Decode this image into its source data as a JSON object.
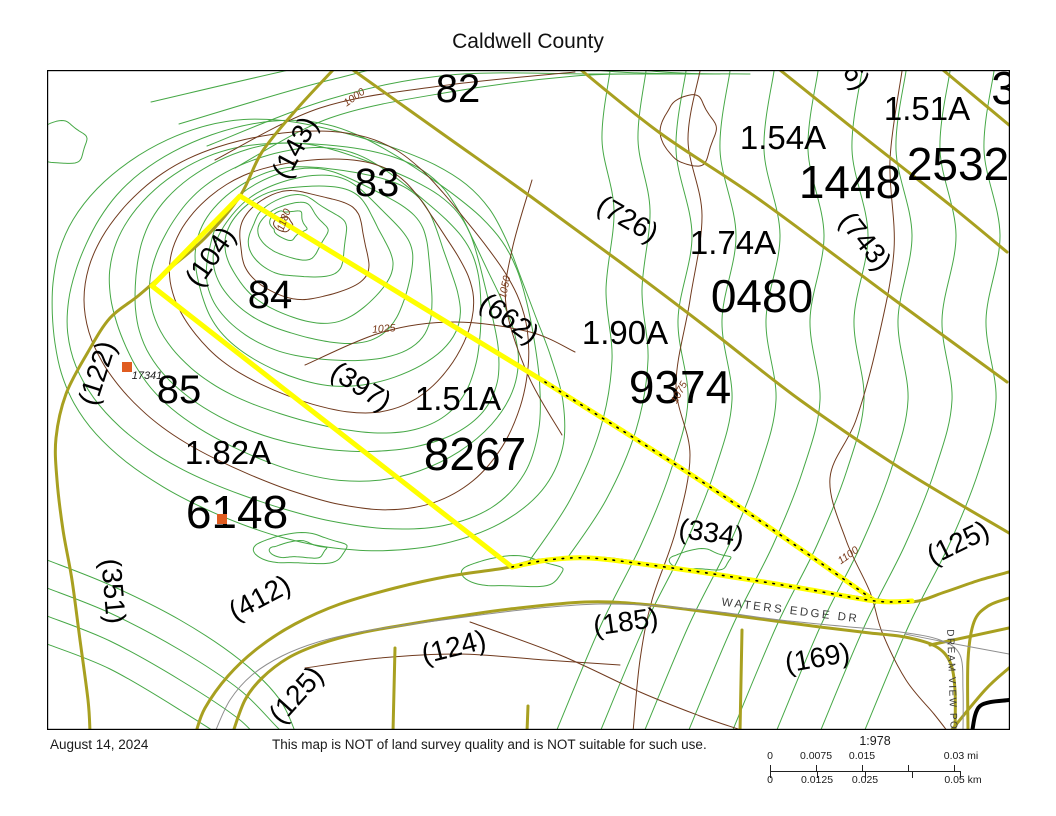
{
  "title": "Caldwell County",
  "footer": {
    "date": "August 14, 2024",
    "disclaimer": "This map is NOT of land survey quality and is NOT suitable for such use.",
    "scale": {
      "ratio": "1:978",
      "mi_ticks": [
        "0",
        "0.0075",
        "0.015",
        "0.03 mi"
      ],
      "km_ticks": [
        "0",
        "0.0125",
        "0.025",
        "0.05 km"
      ]
    }
  },
  "colors": {
    "contour_green": "#46a846",
    "contour_brown": "#703a1e",
    "parcel_olive": "#a8a020",
    "highlight_yellow": "#ffff00",
    "road_centerline_gray": "#8f8f8f",
    "marker_orange": "#e05c20",
    "text_black": "#000000"
  },
  "map": {
    "parcels": [
      {
        "number": "8267",
        "acreage": "1.51A"
      },
      {
        "number": "9374",
        "acreage": "1.90A"
      },
      {
        "number": "6148",
        "acreage": "1.82A"
      },
      {
        "number": "0480",
        "acreage": "1.74A"
      },
      {
        "number": "1448",
        "acreage": "1.54A"
      },
      {
        "number": "2532",
        "acreage": "1.51A"
      },
      {
        "number": "82"
      },
      {
        "number": "83"
      },
      {
        "number": "84"
      },
      {
        "number": "85"
      }
    ],
    "roads": [
      "WATERS EDGE DR",
      "DREAM VIEW POINT"
    ],
    "contour_elevations": [
      "1000",
      "1180",
      "1025",
      "1050",
      "1075",
      "1100"
    ],
    "site_number": "17341",
    "labels": [
      {
        "text": "82",
        "x": 458,
        "y": 102,
        "rot": 0,
        "cls": "num-sm"
      },
      {
        "text": "83",
        "x": 377,
        "y": 196,
        "rot": 0,
        "cls": "num-sm"
      },
      {
        "text": "84",
        "x": 270,
        "y": 308,
        "rot": 0,
        "cls": "num-sm"
      },
      {
        "text": "85",
        "x": 179,
        "y": 403,
        "rot": 0,
        "cls": "num-sm"
      },
      {
        "text": "3",
        "x": 1004,
        "y": 104,
        "rot": 0,
        "cls": "num-lg"
      },
      {
        "text": "2532",
        "x": 958,
        "y": 180,
        "rot": 0,
        "cls": "num-lg"
      },
      {
        "text": "1448",
        "x": 850,
        "y": 198,
        "rot": 0,
        "cls": "num-lg"
      },
      {
        "text": "0480",
        "x": 762,
        "y": 312,
        "rot": 0,
        "cls": "num-lg"
      },
      {
        "text": "9374",
        "x": 680,
        "y": 403,
        "rot": 0,
        "cls": "num-lg"
      },
      {
        "text": "8267",
        "x": 475,
        "y": 470,
        "rot": 0,
        "cls": "num-lg"
      },
      {
        "text": "6148",
        "x": 237,
        "y": 528,
        "rot": 0,
        "cls": "num-lg"
      },
      {
        "text": "1.51A",
        "x": 927,
        "y": 120,
        "rot": 0,
        "cls": "acre"
      },
      {
        "text": "1.54A",
        "x": 783,
        "y": 149,
        "rot": 0,
        "cls": "acre"
      },
      {
        "text": "1.74A",
        "x": 733,
        "y": 254,
        "rot": 0,
        "cls": "acre"
      },
      {
        "text": "1.90A",
        "x": 625,
        "y": 344,
        "rot": 0,
        "cls": "acre"
      },
      {
        "text": "1.51A",
        "x": 458,
        "y": 410,
        "rot": 0,
        "cls": "acre"
      },
      {
        "text": "1.82A",
        "x": 228,
        "y": 464,
        "rot": 0,
        "cls": "acre"
      },
      {
        "text": "(143)",
        "x": 303,
        "y": 152,
        "rot": -62,
        "cls": "dim"
      },
      {
        "text": "(104)",
        "x": 218,
        "y": 262,
        "rot": -55,
        "cls": "dim"
      },
      {
        "text": "(122)",
        "x": 106,
        "y": 376,
        "rot": -72,
        "cls": "dim"
      },
      {
        "text": "(726)",
        "x": 623,
        "y": 227,
        "rot": 30,
        "cls": "dim"
      },
      {
        "text": "6)",
        "x": 849,
        "y": 82,
        "rot": 52,
        "cls": "dim"
      },
      {
        "text": "(743)",
        "x": 858,
        "y": 247,
        "rot": 52,
        "cls": "dim"
      },
      {
        "text": "(662)",
        "x": 504,
        "y": 326,
        "rot": 36,
        "cls": "dim"
      },
      {
        "text": "(397)",
        "x": 356,
        "y": 394,
        "rot": 33,
        "cls": "dim"
      },
      {
        "text": "(334)",
        "x": 710,
        "y": 542,
        "rot": 8,
        "cls": "dim"
      },
      {
        "text": "(125)",
        "x": 962,
        "y": 551,
        "rot": -26,
        "cls": "dim"
      },
      {
        "text": "(351)",
        "x": 104,
        "y": 592,
        "rot": 85,
        "cls": "dim"
      },
      {
        "text": "(412)",
        "x": 264,
        "y": 606,
        "rot": -28,
        "cls": "dim"
      },
      {
        "text": "(124)",
        "x": 456,
        "y": 656,
        "rot": -14,
        "cls": "dim"
      },
      {
        "text": "(125)",
        "x": 303,
        "y": 701,
        "rot": -48,
        "cls": "dim"
      },
      {
        "text": "(185)",
        "x": 627,
        "y": 631,
        "rot": -8,
        "cls": "dim"
      },
      {
        "text": "(169)",
        "x": 819,
        "y": 667,
        "rot": -10,
        "cls": "dim"
      },
      {
        "text": "1000",
        "x": 356,
        "y": 100,
        "rot": -35,
        "cls": "contour"
      },
      {
        "text": "1180",
        "x": 287,
        "y": 221,
        "rot": -70,
        "cls": "contour"
      },
      {
        "text": "1025",
        "x": 384,
        "y": 332,
        "rot": -4,
        "cls": "contour"
      },
      {
        "text": "1050",
        "x": 508,
        "y": 288,
        "rot": -78,
        "cls": "contour"
      },
      {
        "text": "1075",
        "x": 682,
        "y": 394,
        "rot": -62,
        "cls": "contour"
      },
      {
        "text": "1100",
        "x": 850,
        "y": 558,
        "rot": -35,
        "cls": "contour"
      },
      {
        "text": "17341",
        "x": 147,
        "y": 379,
        "rot": 0,
        "cls": "site"
      },
      {
        "text": "WATERS EDGE DR",
        "x": 790,
        "y": 614,
        "rot": 7,
        "cls": "road"
      },
      {
        "text": "DREAM VIEW POI",
        "x": 949,
        "y": 682,
        "rot": 88,
        "cls": "road-v"
      }
    ],
    "markers": [
      {
        "x": 122,
        "y": 362
      },
      {
        "x": 217,
        "y": 514
      }
    ]
  }
}
